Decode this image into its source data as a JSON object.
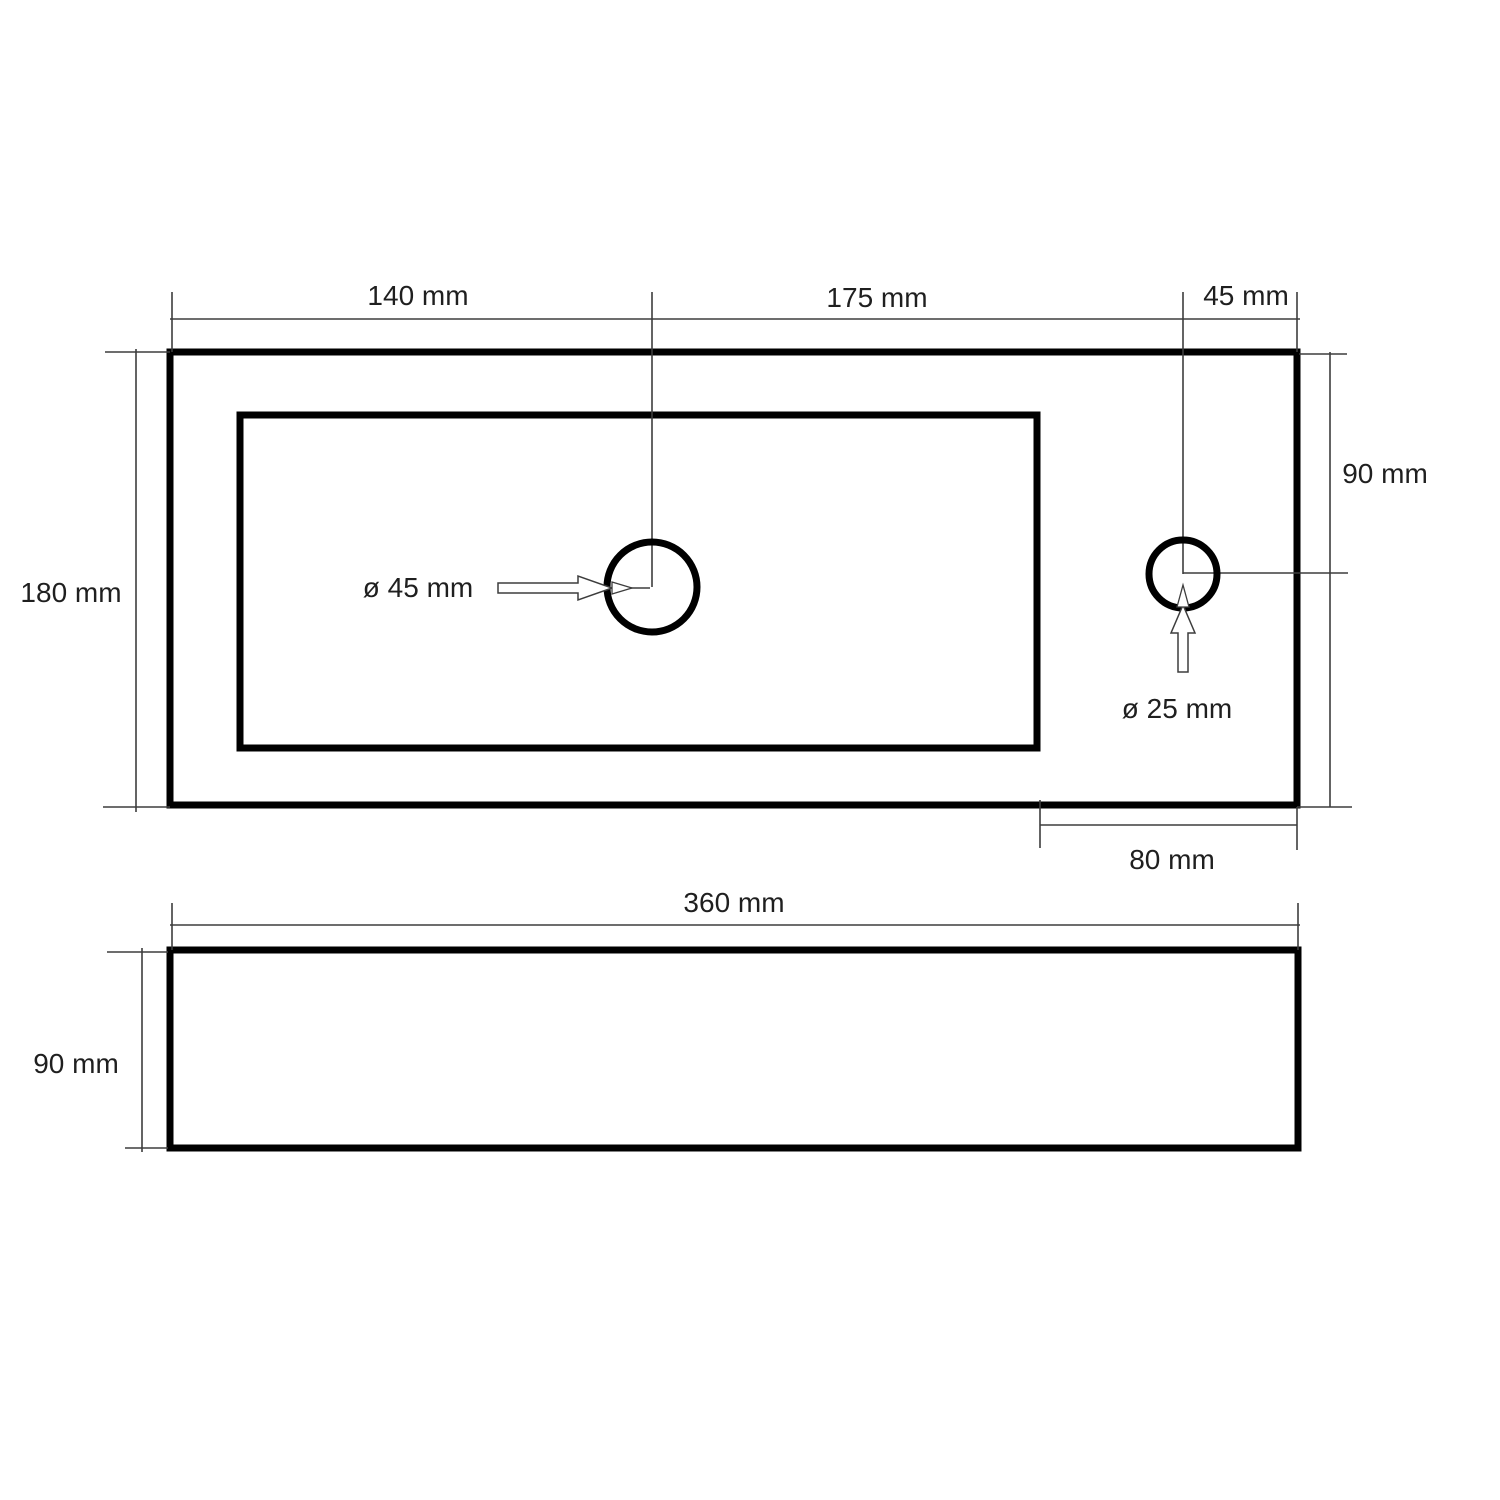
{
  "top_view": {
    "label_width_left": "140 mm",
    "label_width_mid": "175 mm",
    "label_width_right": "45 mm",
    "label_height_left": "180 mm",
    "label_height_right": "90 mm",
    "label_drain_diameter": "ø 45 mm",
    "label_tap_hole_diameter": "ø 25 mm",
    "label_deck_width": "80 mm"
  },
  "side_view": {
    "label_width": "360 mm",
    "label_height": "90 mm"
  },
  "colors": {
    "outline": "#000000",
    "dimension_line": "#3d3d3d",
    "text": "#1f1f1f",
    "background": "#ffffff"
  }
}
